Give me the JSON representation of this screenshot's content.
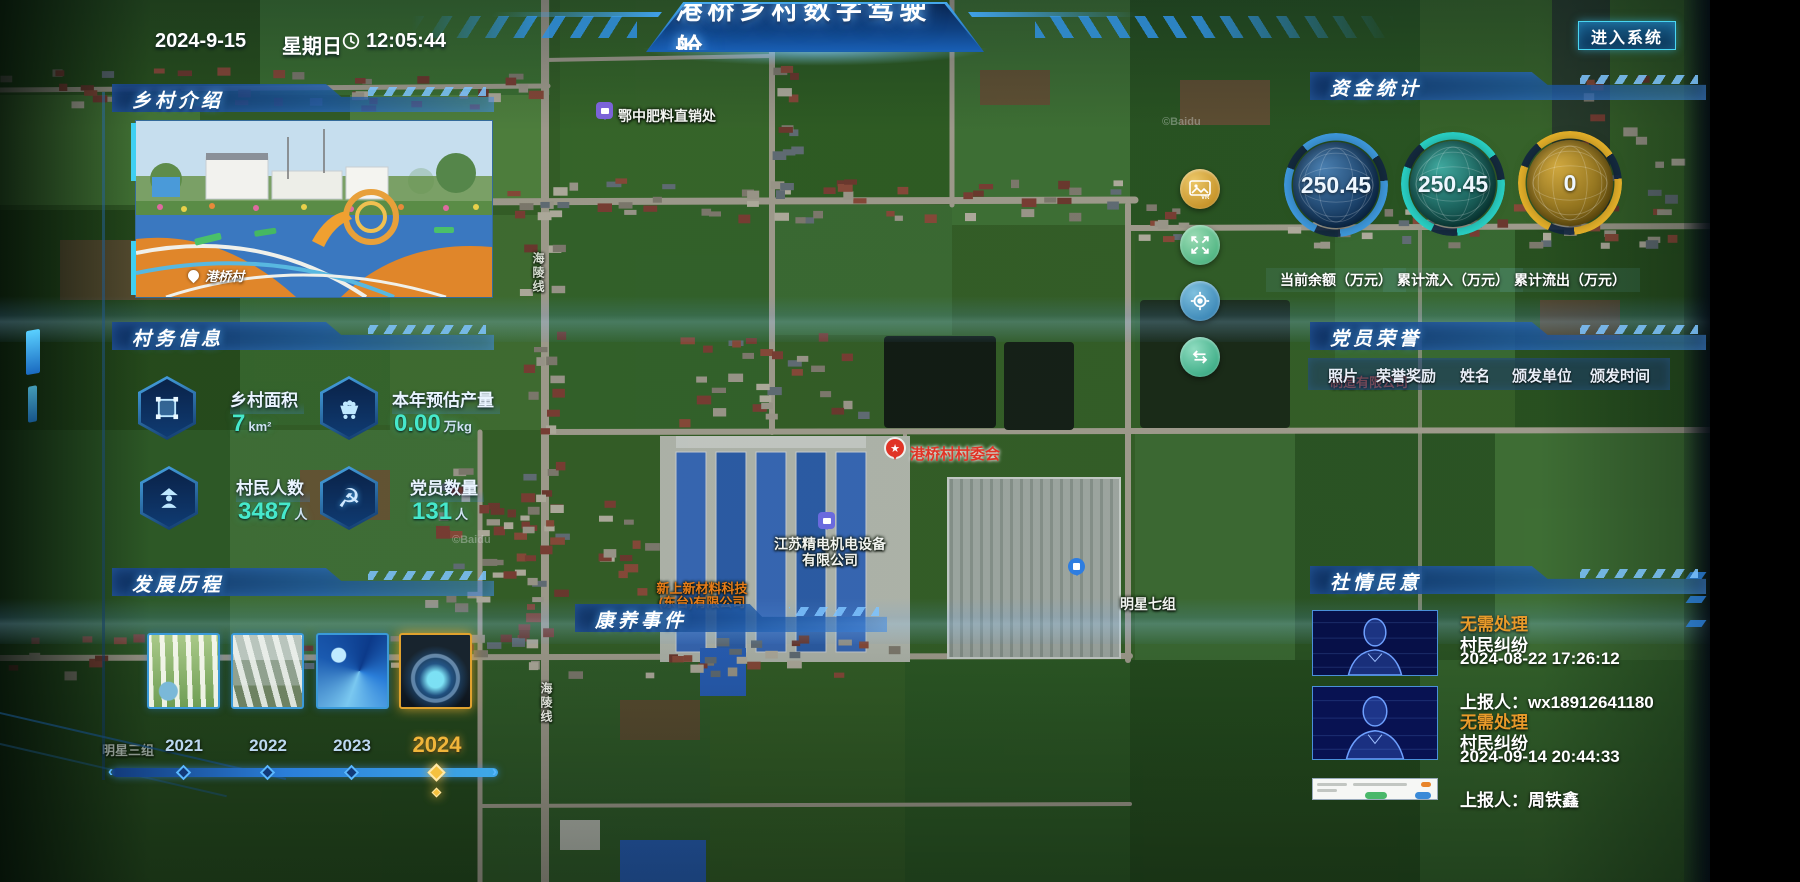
{
  "meta": {
    "date": "2024-9-15",
    "weekday": "星期日",
    "time": "12:05:44"
  },
  "header": {
    "title": "港桥乡村数字驾驶舱",
    "left_chevron": "«",
    "right_chevron": "»",
    "enter_button": "进入系统"
  },
  "colors": {
    "accent_cyan": "#49d6f2",
    "highlight_gold": "#f0b53a",
    "status_orange": "#e89a2a",
    "gauge_blue": "#3f9be0",
    "gauge_teal": "#2ad4c8",
    "gauge_gold": "#e8b32a"
  },
  "panels": {
    "intro": {
      "title": "乡村介绍",
      "photo_caption": "港桥村"
    },
    "village_info": {
      "title": "村务信息",
      "stats": [
        {
          "label": "乡村面积",
          "value": "7",
          "unit": "km²",
          "icon": "area-icon"
        },
        {
          "label": "本年预估产量",
          "value": "0.00",
          "unit": "万kg",
          "icon": "cart-icon"
        },
        {
          "label": "村民人数",
          "value": "3487",
          "unit": "人",
          "icon": "villager-icon"
        },
        {
          "label": "党员数量",
          "value": "131",
          "unit": "人",
          "icon": "party-icon"
        }
      ]
    },
    "development": {
      "title": "发展历程",
      "years": [
        {
          "label": "2021",
          "active": false
        },
        {
          "label": "2022",
          "active": false
        },
        {
          "label": "2023",
          "active": false
        },
        {
          "label": "2024",
          "active": true
        }
      ]
    },
    "funds": {
      "title": "资金统计",
      "gauges": [
        {
          "value": "250.45",
          "label": "当前余额（万元）",
          "color": "#3f9be0"
        },
        {
          "value": "250.45",
          "label": "累计流入（万元）",
          "color": "#2ad4c8"
        },
        {
          "value": "0",
          "label": "累计流出（万元）",
          "color": "#e8b32a"
        }
      ]
    },
    "party_honor": {
      "title": "党员荣誉",
      "columns": [
        "照片",
        "荣誉奖励",
        "姓名",
        "颁发单位",
        "颁发时间"
      ]
    },
    "public_opinion": {
      "title": "社情民意",
      "entries": [
        {
          "status": "无需处理",
          "type": "村民纠纷",
          "time": "2024-08-22 17:26:12",
          "reporter": "上报人：wx18912641180"
        },
        {
          "status": "无需处理",
          "type": "村民纠纷",
          "time": "2024-09-14 20:44:33",
          "reporter": "上报人：周铁鑫"
        }
      ]
    },
    "health_events": {
      "title": "康养事件"
    }
  },
  "map": {
    "labels": {
      "fertilizer": "鄂中肥料直销处",
      "committee": "港桥村村委会",
      "company1_l1": "江苏精电机电设备",
      "company1_l2": "有限公司",
      "company2_l1": "新上新材料科技",
      "company2_l2": "(东台)有限公司",
      "group7": "明星七组",
      "group3": "明星三组",
      "road": "海陵线",
      "partial_company": "制造有限公司",
      "watermark": "©Baidu"
    },
    "controls": {
      "vr": "vr-image",
      "expand": "expand",
      "locate": "locate",
      "switch": "switch-view"
    }
  }
}
